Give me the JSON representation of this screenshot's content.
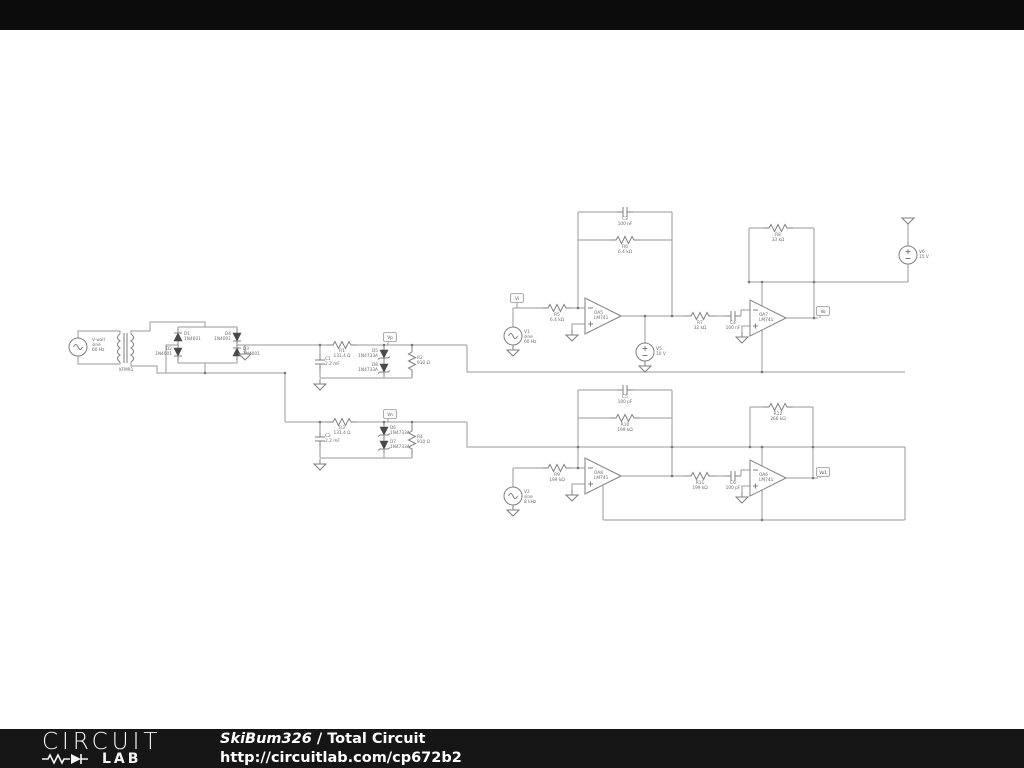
{
  "footer": {
    "logo_line1": "CIRCUIT",
    "logo_line2": "LAB",
    "author": "SkiBum326",
    "separator": " / ",
    "title": "Total Circuit",
    "url": "http://circuitlab.com/cp672b2"
  },
  "nets": {
    "vp": "Vp",
    "vn": "Vn",
    "vi": "Vi",
    "vo": "Vo",
    "vo1": "Vo1"
  },
  "components": {
    "vwall": {
      "ref": "V-wall",
      "l2": "sine",
      "l3": "60 Hz"
    },
    "xfmr1": {
      "ref": "XFMR1"
    },
    "d1": {
      "ref": "D1",
      "model": "1N4001"
    },
    "d2": {
      "ref": "D2",
      "model": "1N4001"
    },
    "d3": {
      "ref": "D3",
      "model": "1N4001"
    },
    "d4": {
      "ref": "D4",
      "model": "1N4001"
    },
    "r1": {
      "ref": "R1",
      "value": "131.4 Ω"
    },
    "c1": {
      "ref": "C1",
      "value": "2.2 mF"
    },
    "d5": {
      "ref": "D5",
      "model": "1N4733A"
    },
    "d8": {
      "ref": "D8",
      "model": "1N4733A"
    },
    "r2": {
      "ref": "R2",
      "value": "910 Ω"
    },
    "r3": {
      "ref": "R3",
      "value": "131.4 Ω"
    },
    "c2": {
      "ref": "C2",
      "value": "2.2 mF"
    },
    "d6": {
      "ref": "D6",
      "model": "1N4733A"
    },
    "d7": {
      "ref": "D7",
      "model": "1N4733A"
    },
    "r4": {
      "ref": "R4",
      "value": "910 Ω"
    },
    "v1": {
      "ref": "V1",
      "l2": "sine",
      "l3": "60 Hz"
    },
    "r5": {
      "ref": "R5",
      "value": "6.4 kΩ"
    },
    "c3": {
      "ref": "C3",
      "value": "100 nF"
    },
    "r6": {
      "ref": "R6",
      "value": "6.4 kΩ"
    },
    "oa5": {
      "ref": "OA5",
      "model": "LM741"
    },
    "v5": {
      "ref": "V5",
      "value": "10 V"
    },
    "r7": {
      "ref": "R7",
      "value": "32 kΩ"
    },
    "c4": {
      "ref": "C4",
      "value": "100 nF"
    },
    "oa7": {
      "ref": "OA7",
      "model": "LM741"
    },
    "r8": {
      "ref": "R8",
      "value": "33 kΩ"
    },
    "v6": {
      "ref": "V6",
      "value": "15 V"
    },
    "v2": {
      "ref": "V2",
      "l2": "sine",
      "l3": "8 kHz"
    },
    "r9": {
      "ref": "R9",
      "value": "199 kΩ"
    },
    "c5": {
      "ref": "C5",
      "value": "100 pF"
    },
    "r10": {
      "ref": "R10",
      "value": "199 kΩ"
    },
    "oa8": {
      "ref": "OA8",
      "model": "LM741"
    },
    "r11": {
      "ref": "R11",
      "value": "199 kΩ"
    },
    "c6": {
      "ref": "C6",
      "value": "100 pF"
    },
    "oa6": {
      "ref": "OA6",
      "model": "LM741"
    },
    "r12": {
      "ref": "R12",
      "value": "266 kΩ"
    }
  }
}
